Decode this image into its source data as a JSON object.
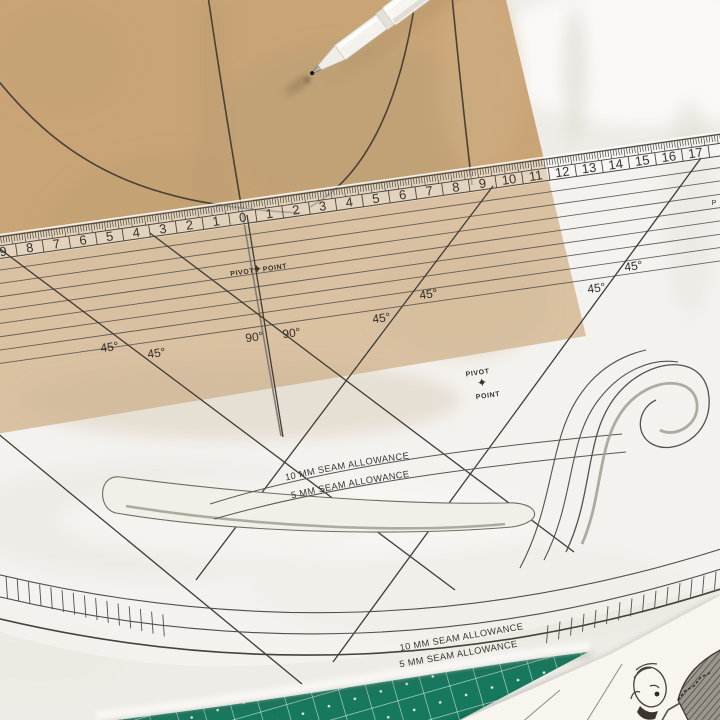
{
  "photo": {
    "alt": "Transparent pattern-making ruler with curved cutouts lying over brown kraft paper and white fabric, with a white marking pen and a green cutting mat"
  },
  "ruler": {
    "scale_numbers": [
      "9",
      "8",
      "7",
      "6",
      "5",
      "4",
      "3",
      "2",
      "1",
      "0",
      "1",
      "2",
      "3",
      "4",
      "5",
      "6",
      "7",
      "8",
      "9",
      "10",
      "11",
      "12",
      "13",
      "14",
      "15",
      "16",
      "17"
    ],
    "pivot_word_1": "PIVOT",
    "pivot_word_2": "POINT",
    "angle_45_label": "45°",
    "angle_90_label": "90°",
    "seam_allowance_10mm": "10 MM SEAM ALLOWANCE",
    "seam_allowance_5mm": "5 MM SEAM ALLOWANCE",
    "edge_text_fragment": "P"
  },
  "colors": {
    "kraft_paper": "#c9a476",
    "fabric": "#efece7",
    "cutting_mat_green": "#16795d",
    "ruler_ink": "#45423b",
    "pen_white": "#f7f5f0"
  }
}
